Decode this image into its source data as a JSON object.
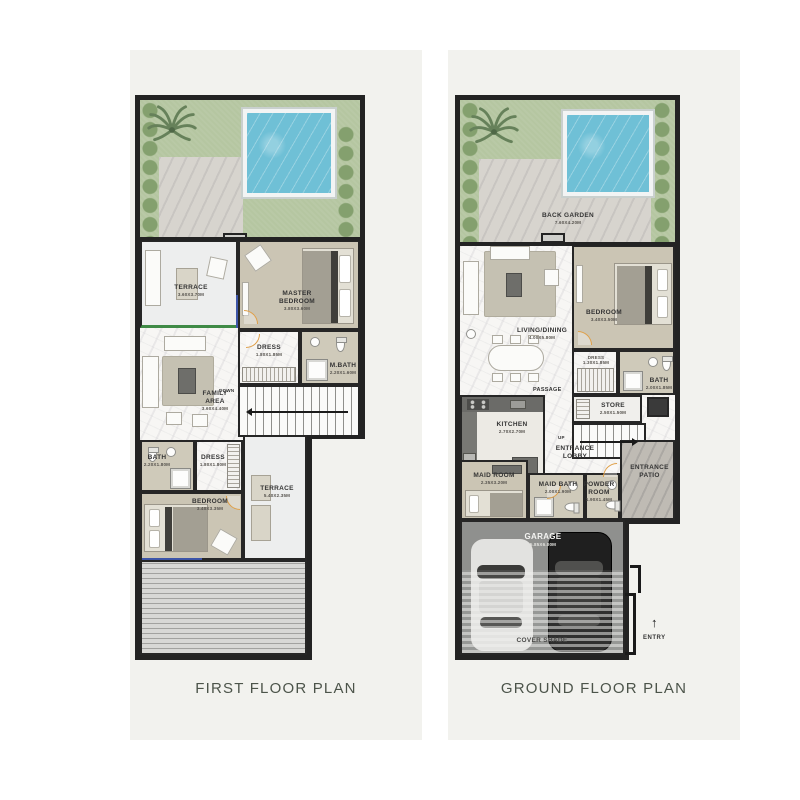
{
  "page": {
    "colors": {
      "background": "#ffffff",
      "panel": "#f2f2ee",
      "wall": "#232323",
      "grass": "#b5c6a1",
      "pool": "#6fc0d6",
      "bedroom_floor": "#cbc5b4",
      "marble_floor": "#f7f6f4",
      "garage_floor": "#8f908e",
      "title_text": "#4c544a",
      "door_accent": "#dfa04a"
    }
  },
  "first_floor": {
    "title": "FIRST FLOOR PLAN",
    "rooms": {
      "terrace_upper": {
        "label": "TERRACE",
        "dims": "3.60X3.70M"
      },
      "master_bedroom": {
        "label": "MASTER BEDROOM",
        "dims": "3.80X3.60M"
      },
      "dress_master": {
        "label": "DRESS",
        "dims": "1.80X1.85M"
      },
      "master_bath": {
        "label": "M.BATH",
        "dims": "2.20X1.60M"
      },
      "family_area": {
        "label": "FAMILY AREA",
        "dims": "3.60X4.40M"
      },
      "stairs": {
        "label": "DOWN"
      },
      "bath": {
        "label": "BATH",
        "dims": "2.20X1.80M"
      },
      "dress_lower": {
        "label": "DRESS",
        "dims": "1.80X1.80M"
      },
      "bedroom": {
        "label": "BEDROOM",
        "dims": "3.40X3.35M"
      },
      "terrace_lower": {
        "label": "TERRACE",
        "dims": "5.40X2.35M"
      }
    }
  },
  "ground_floor": {
    "title": "GROUND FLOOR PLAN",
    "rooms": {
      "back_garden": {
        "label": "BACK GARDEN",
        "dims": "7.60X4.20M"
      },
      "living_dining": {
        "label": "LIVING/DINING",
        "dims": "4.00X5.80M"
      },
      "bedroom": {
        "label": "BEDROOM",
        "dims": "3.40X3.50M"
      },
      "dress": {
        "label": "DRESS 1.30X1.85M"
      },
      "bath": {
        "label": "BATH",
        "dims": "2.00X1.85M"
      },
      "passage": {
        "label": "PASSAGE"
      },
      "store": {
        "label": "STORE",
        "dims": "2.50X1.50M"
      },
      "stairs": {
        "label": "UP"
      },
      "kitchen": {
        "label": "KITCHEN",
        "dims": "2.70X2.70M"
      },
      "entrance_lobby": {
        "label": "ENTRANCE LOBBY"
      },
      "entrance_patio": {
        "label": "ENTRANCE PATIO"
      },
      "maid_room": {
        "label": "MAID ROOM",
        "dims": "2.35X3.20M"
      },
      "maid_bath": {
        "label": "MAID BATH",
        "dims": "2.00X1.90M"
      },
      "powder_room": {
        "label": "POWDER ROOM",
        "dims": "1.90X1.45M"
      },
      "garage": {
        "label": "GARAGE",
        "dims": "5.85X6.00M"
      },
      "cover_shade": {
        "label": "COVER SHADE"
      },
      "entry": {
        "label": "ENTRY"
      }
    }
  }
}
